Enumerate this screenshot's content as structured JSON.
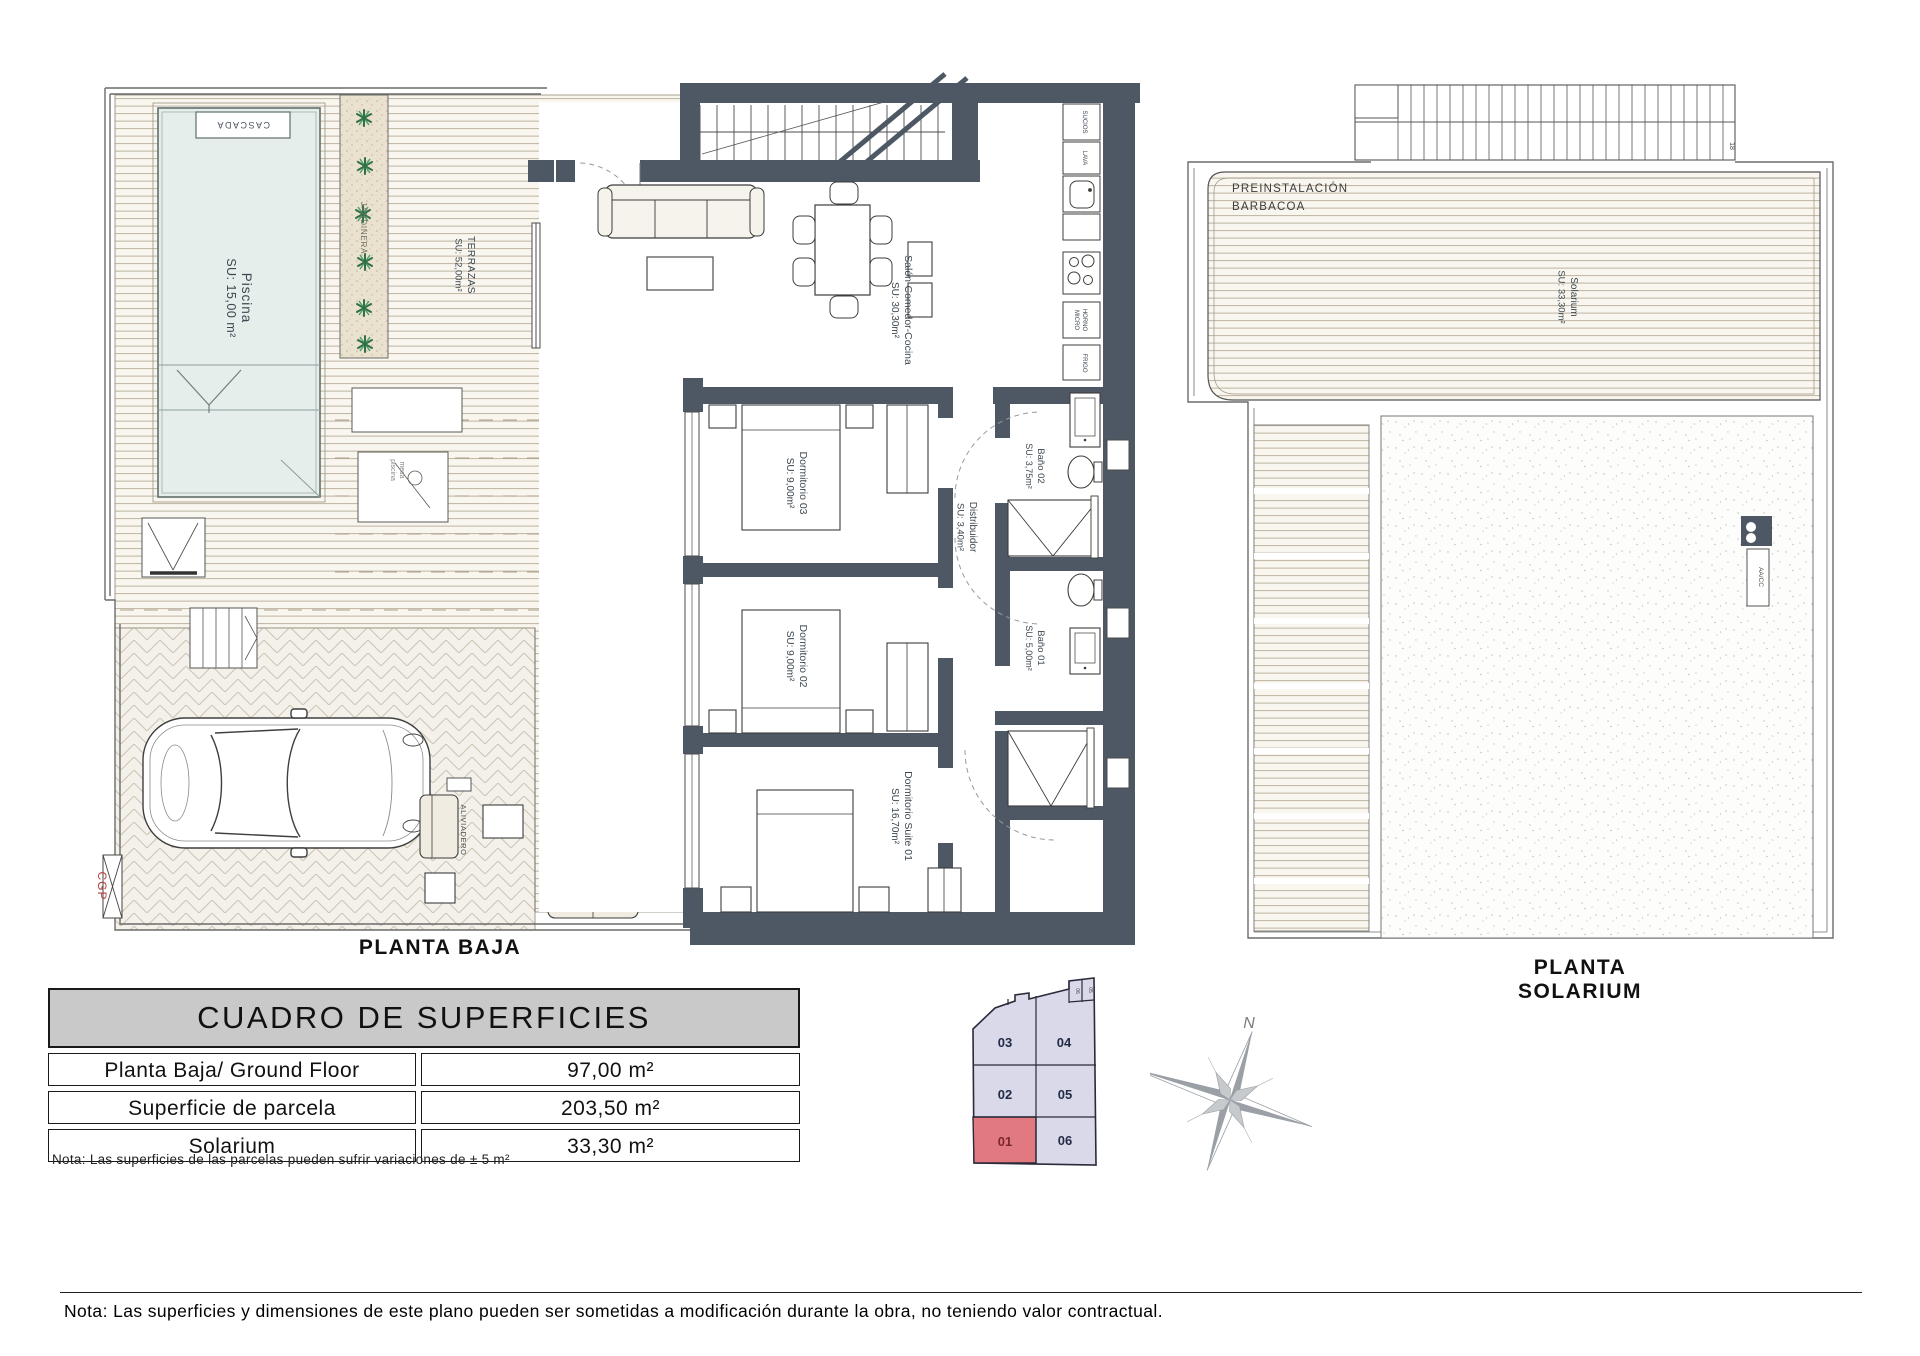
{
  "colors": {
    "wall": "#4d5864",
    "deck_line": "#bdb4a0",
    "pool_fill": "#e6eeeb",
    "planter_fill": "#eae2cf",
    "plant_green": "#2f7046",
    "plot_fill": "#d9d9ea",
    "plot_highlight": "#e07980",
    "red_label": "#b5413c",
    "table_header_bg": "#c9c9c9"
  },
  "planta_baja": {
    "caption": "PLANTA BAJA",
    "cascada": "CASCADA",
    "piscina_name": "Piscina",
    "piscina_su": "SU: 15,00 m²",
    "jardinera": "JARDINERA",
    "terrazas_name": "TERRAZAS",
    "terrazas_su": "SU: 52,00m²",
    "salon_name": "Salón-Comedor-Cocina",
    "salon_su": "SU: 30,30m²",
    "kitchen": {
      "sucios": "SUCIOS",
      "lava": "LAVA",
      "horno": "HORNO",
      "micro": "MICRO",
      "frigo": "FRIGO"
    },
    "dorm03_name": "Dormitorio 03",
    "dorm03_su": "SU: 9,00m²",
    "dorm02_name": "Dormitorio 02",
    "dorm02_su": "SU: 9,00m²",
    "suite_name": "Dormitorio Suite 01",
    "suite_su": "SU: 16,70m²",
    "distribuidor_name": "Distribuidor",
    "distribuidor_su": "SU: 3,40m²",
    "bano02_name": "Baño 02",
    "bano02_su": "SU: 3,75m²",
    "bano01_name": "Baño 01",
    "bano01_su": "SU: 5,00m²",
    "aliviadero": "ALIVIADERO",
    "cgp": "CGP",
    "mesa_line1": "mesa",
    "mesa_line2": "piscina"
  },
  "solarium": {
    "caption": "PLANTA SOLARIUM",
    "barbacoa1": "PREINSTALACIÓN",
    "barbacoa2": "BARBACOA",
    "name": "Solarium",
    "su": "SU: 33,30m²",
    "aacc": "AA/CC",
    "corner": "18"
  },
  "table": {
    "title": "CUADRO DE SUPERFICIES",
    "rows": [
      {
        "label": "Planta Baja/ Ground Floor",
        "value": "97,00 m²"
      },
      {
        "label": "Superficie de parcela",
        "value": "203,50 m²"
      },
      {
        "label": "Solarium",
        "value": "33,30 m²"
      }
    ],
    "note": "Nota: Las superficies de las parcelas pueden sufrir variaciones de ± 5 m²"
  },
  "siteplan": {
    "plots": [
      {
        "id": "03",
        "highlight": false
      },
      {
        "id": "04",
        "highlight": false
      },
      {
        "id": "02",
        "highlight": false
      },
      {
        "id": "05",
        "highlight": false
      },
      {
        "id": "01",
        "highlight": true
      },
      {
        "id": "06",
        "highlight": false
      }
    ],
    "corner_left": "06",
    "corner_right": "05"
  },
  "compass": {
    "n": "N"
  },
  "footer": {
    "note": "Nota: Las superficies y dimensiones de este plano pueden ser sometidas a modificación durante la obra, no teniendo valor contractual."
  }
}
